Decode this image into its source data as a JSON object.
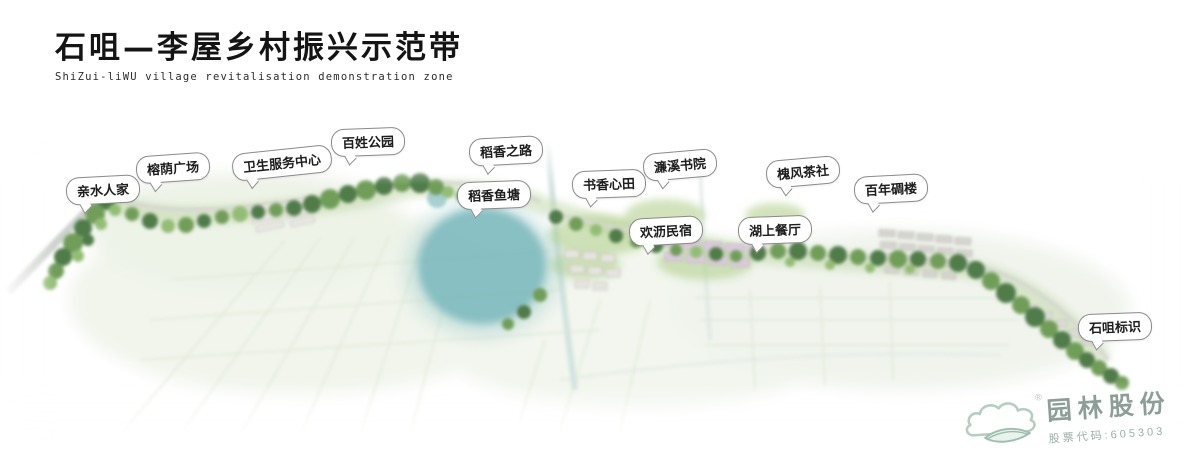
{
  "title": {
    "zh": "石咀—李屋乡村振兴示范带",
    "en": "ShiZui-liWU village revitalisation demonstration zone"
  },
  "callouts": [
    {
      "id": "qinshui-renjia",
      "label": "亲水人家"
    },
    {
      "id": "rongyin-plaza",
      "label": "榕荫广场"
    },
    {
      "id": "health-service-center",
      "label": "卫生服务中心"
    },
    {
      "id": "baixing-park",
      "label": "百姓公园"
    },
    {
      "id": "daoxiang-road",
      "label": "稻香之路"
    },
    {
      "id": "daoxiang-fishpond",
      "label": "稻香鱼塘"
    },
    {
      "id": "shuxiang-xintian",
      "label": "书香心田"
    },
    {
      "id": "lianxi-academy",
      "label": "濂溪书院"
    },
    {
      "id": "huanli-homestay",
      "label": "欢沥民宿"
    },
    {
      "id": "lake-restaurant",
      "label": "湖上餐厅"
    },
    {
      "id": "huaifeng-teahouse",
      "label": "槐风茶社"
    },
    {
      "id": "century-watchtower",
      "label": "百年碉楼"
    },
    {
      "id": "shizui-landmark",
      "label": "石咀标识"
    }
  ],
  "logo": {
    "company": "园林股份",
    "stock_code_label": "股票代码:605303",
    "registered": "®"
  },
  "colors": {
    "tree_dark": "#4f7b49",
    "tree_mid": "#6f9e58",
    "tree_light": "#93bd74",
    "lake": "#75b5ba",
    "road": "#d6d6d1",
    "bubble_border": "#8a8a8a",
    "logo_green": "#b5cec1",
    "logo_text": "#8d9d97"
  }
}
